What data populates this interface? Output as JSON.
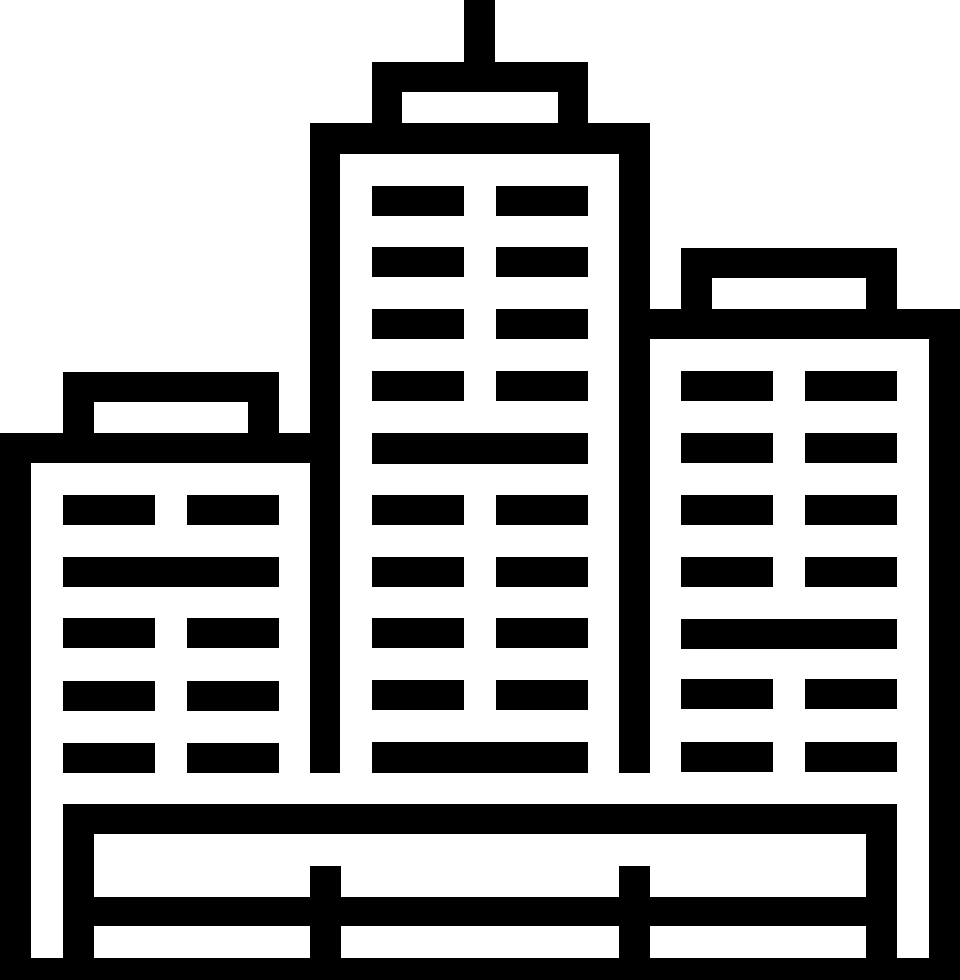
{
  "palette": {
    "foreground": "#000000",
    "background": "#ffffff"
  },
  "canvas": {
    "width": 960,
    "height": 980
  },
  "icon": {
    "name": "city-skyline-icon",
    "description": "black outline pictogram of three high-rise buildings with window grids, rooftop signs, a center antenna, and a fenced plaza base",
    "groups": [
      {
        "name": "center-tower",
        "rects": [
          [
            464,
            0,
            31,
            92,
            "antenna"
          ],
          [
            372,
            62,
            216,
            30,
            "crown-top"
          ],
          [
            372,
            92,
            30,
            31,
            "crown-left"
          ],
          [
            558,
            92,
            30,
            31,
            "crown-right"
          ],
          [
            310,
            123,
            340,
            31,
            "roof-bar"
          ],
          [
            310,
            154,
            30,
            619,
            "left-wall"
          ],
          [
            619,
            154,
            31,
            619,
            "right-wall"
          ],
          [
            372,
            186,
            92,
            30,
            "window"
          ],
          [
            496,
            186,
            92,
            30,
            "window"
          ],
          [
            372,
            247,
            92,
            30,
            "window"
          ],
          [
            496,
            247,
            92,
            30,
            "window"
          ],
          [
            372,
            309,
            92,
            30,
            "window"
          ],
          [
            496,
            309,
            92,
            30,
            "window"
          ],
          [
            372,
            371,
            92,
            30,
            "window"
          ],
          [
            496,
            371,
            92,
            30,
            "window"
          ],
          [
            372,
            433,
            216,
            31,
            "window-band"
          ],
          [
            372,
            495,
            92,
            30,
            "window"
          ],
          [
            496,
            495,
            92,
            30,
            "window"
          ],
          [
            372,
            557,
            92,
            30,
            "window"
          ],
          [
            496,
            557,
            92,
            30,
            "window"
          ],
          [
            372,
            618,
            92,
            30,
            "window"
          ],
          [
            496,
            618,
            92,
            30,
            "window"
          ],
          [
            372,
            680,
            92,
            30,
            "window"
          ],
          [
            496,
            680,
            92,
            30,
            "window"
          ],
          [
            372,
            742,
            216,
            31,
            "window-band"
          ]
        ]
      },
      {
        "name": "left-building",
        "rects": [
          [
            63,
            372,
            216,
            30,
            "sign-top"
          ],
          [
            63,
            402,
            31,
            31,
            "sign-left"
          ],
          [
            248,
            402,
            31,
            31,
            "sign-right"
          ],
          [
            0,
            433,
            310,
            30,
            "roof-bar"
          ],
          [
            0,
            463,
            31,
            495,
            "left-wall"
          ],
          [
            63,
            495,
            92,
            30,
            "window"
          ],
          [
            187,
            495,
            92,
            30,
            "window"
          ],
          [
            63,
            557,
            216,
            30,
            "window-band"
          ],
          [
            63,
            618,
            92,
            30,
            "window"
          ],
          [
            187,
            618,
            92,
            30,
            "window"
          ],
          [
            63,
            681,
            92,
            30,
            "window"
          ],
          [
            187,
            681,
            92,
            30,
            "window"
          ],
          [
            63,
            743,
            92,
            30,
            "window"
          ],
          [
            187,
            743,
            92,
            30,
            "window"
          ]
        ]
      },
      {
        "name": "right-building",
        "rects": [
          [
            681,
            248,
            216,
            30,
            "sign-top"
          ],
          [
            681,
            278,
            31,
            31,
            "sign-left"
          ],
          [
            866,
            278,
            31,
            31,
            "sign-right"
          ],
          [
            650,
            309,
            310,
            30,
            "roof-bar"
          ],
          [
            929,
            339,
            31,
            619,
            "right-wall"
          ],
          [
            681,
            371,
            92,
            30,
            "window"
          ],
          [
            805,
            371,
            92,
            30,
            "window"
          ],
          [
            681,
            433,
            92,
            30,
            "window"
          ],
          [
            805,
            433,
            92,
            30,
            "window"
          ],
          [
            681,
            495,
            92,
            30,
            "window"
          ],
          [
            805,
            495,
            92,
            30,
            "window"
          ],
          [
            681,
            557,
            92,
            30,
            "window"
          ],
          [
            805,
            557,
            92,
            30,
            "window"
          ],
          [
            681,
            619,
            216,
            30,
            "window-band"
          ],
          [
            681,
            679,
            92,
            30,
            "window"
          ],
          [
            805,
            679,
            92,
            30,
            "window"
          ],
          [
            681,
            742,
            92,
            30,
            "window"
          ],
          [
            805,
            742,
            92,
            30,
            "window"
          ]
        ]
      },
      {
        "name": "plaza-fence",
        "rects": [
          [
            63,
            804,
            834,
            30,
            "plaza-top-bar"
          ],
          [
            63,
            834,
            31,
            124,
            "plaza-left-post"
          ],
          [
            866,
            834,
            31,
            124,
            "plaza-right-post"
          ],
          [
            310,
            866,
            31,
            92,
            "fence-post"
          ],
          [
            619,
            866,
            31,
            92,
            "fence-post"
          ],
          [
            94,
            897,
            772,
            29,
            "fence-rail"
          ],
          [
            0,
            958,
            960,
            22,
            "ground-bar"
          ]
        ]
      }
    ]
  }
}
